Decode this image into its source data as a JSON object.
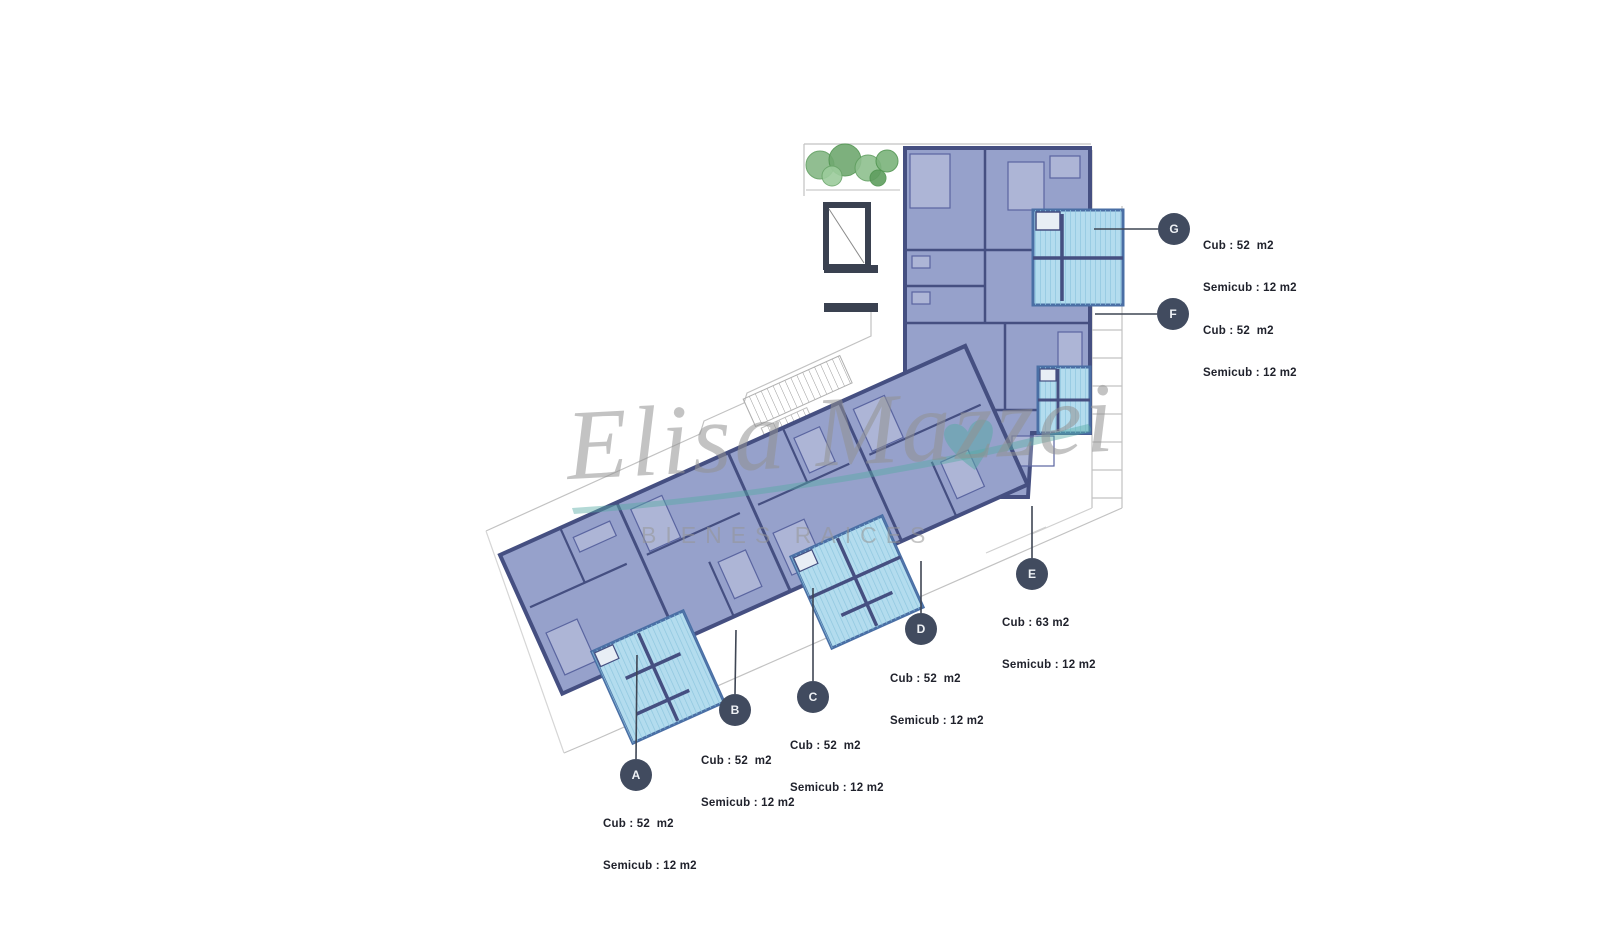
{
  "watermark": {
    "script": "Elisa Mazzei",
    "tagline": "BIENES RAICES"
  },
  "units": [
    {
      "letter": "A",
      "line1": "Cub : 52  m2",
      "line2": "Semicub : 12 m2"
    },
    {
      "letter": "B",
      "line1": "Cub : 52  m2",
      "line2": "Semicub : 12 m2"
    },
    {
      "letter": "C",
      "line1": "Cub : 52  m2",
      "line2": "Semicub : 12 m2"
    },
    {
      "letter": "D",
      "line1": "Cub : 52  m2",
      "line2": "Semicub : 12 m2"
    },
    {
      "letter": "E",
      "line1": "Cub : 63 m2",
      "line2": "Semicub : 12 m2"
    },
    {
      "letter": "F",
      "line1": "Cub : 52  m2",
      "line2": "Semicub : 12 m2"
    },
    {
      "letter": "G",
      "line1": "Cub : 52  m2",
      "line2": "Semicub : 12 m2"
    }
  ],
  "colors": {
    "apartment_fill": "#96a1cb",
    "wall": "#454f81",
    "balcony_fill": "#b3dcee",
    "balcony_hatch": "#8ec6de",
    "balcony_border": "#4a6fa5",
    "marker_circle": "#414b5f",
    "plant_green": "#7ab87a",
    "stair_shaft": "#3a4150",
    "property_line": "#c2c2c2",
    "watermark_gray": "#919191",
    "watermark_teal": "#56aaa4",
    "label_text": "#20222c"
  }
}
